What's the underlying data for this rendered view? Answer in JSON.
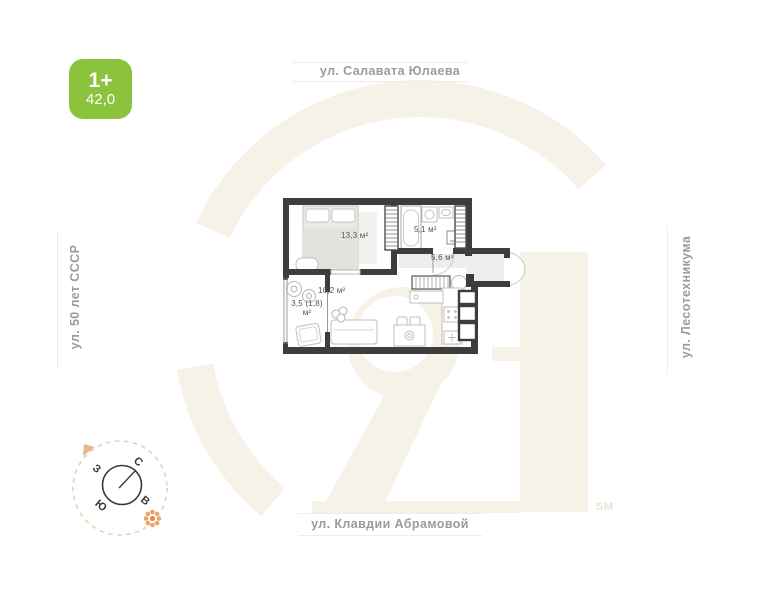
{
  "badge": {
    "rooms_label": "1+",
    "area_value": "42,0"
  },
  "streets": {
    "top": "ул. Салавата Юлаева",
    "bottom": "ул. Клавдии Абрамовой",
    "left": "ул. 50 лет СССР",
    "right": "ул. Лесотехникума"
  },
  "floor_plan": {
    "rooms": [
      {
        "id": "bedroom",
        "area_label": "13,3 м²"
      },
      {
        "id": "bathroom",
        "area_label": "5,1 м²"
      },
      {
        "id": "hallway",
        "area_label": "5,6 м²"
      },
      {
        "id": "living_kitchen",
        "area_label": "16,2 м²"
      },
      {
        "id": "balcony",
        "area_label_line1": "3,5 (1,8)",
        "area_label_line2": "м²"
      }
    ]
  },
  "compass": {
    "north_label": "С",
    "east_label": "В",
    "south_label": "Ю",
    "west_label": "З"
  },
  "watermark": {
    "service_mark": "SM"
  },
  "colors": {
    "badge_green": "#8cc33d",
    "watermark_beige": "#f7f2e7",
    "wall_dark": "#3d3d3d",
    "street_text": "#9b9b9b",
    "hall_floor": "#ededeb"
  }
}
